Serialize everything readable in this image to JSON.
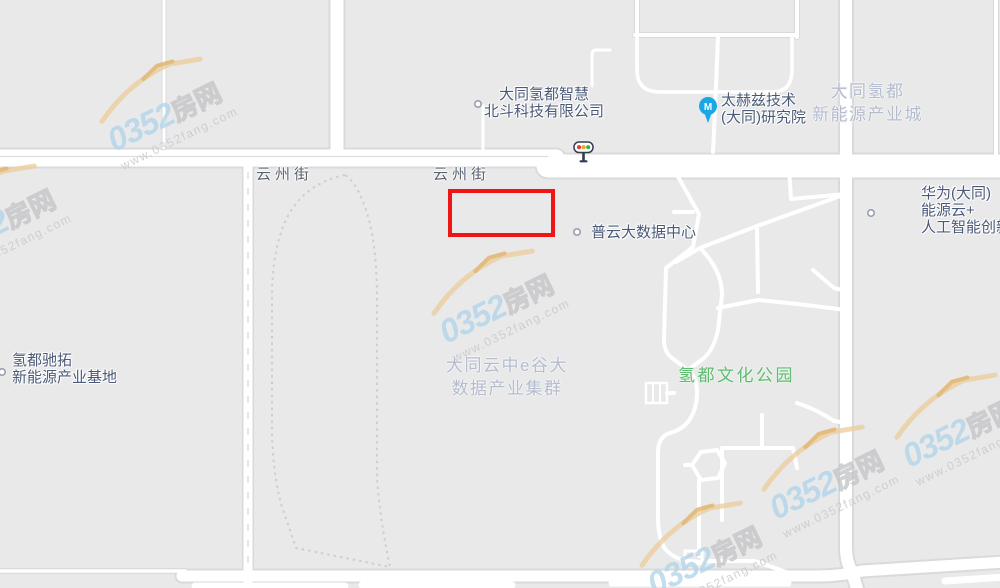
{
  "map": {
    "road_labels": [
      {
        "text": "云州街",
        "x": 256,
        "y": 163
      },
      {
        "text": "云州街",
        "x": 433,
        "y": 163
      }
    ],
    "poi_labels": [
      {
        "id": "beidou-tech",
        "type": "poi",
        "align": "center",
        "x": 484,
        "y": 86,
        "lines": [
          "大同氢都智慧",
          "北斗科技有限公司"
        ]
      },
      {
        "id": "terahertz-institute",
        "type": "poi",
        "x": 721,
        "y": 92,
        "lines": [
          "太赫兹技术",
          "(大同)研究院"
        ]
      },
      {
        "id": "qingdu-industry-city",
        "type": "area",
        "align": "center",
        "x": 812,
        "y": 80,
        "lines": [
          "大同氢都",
          "新能源产业城"
        ]
      },
      {
        "id": "huawei-energy-cloud",
        "type": "poi",
        "x": 921,
        "y": 185,
        "lines": [
          "华为(大同)",
          "能源云+",
          "人工智能创新"
        ]
      },
      {
        "id": "puyun-data-center",
        "type": "poi",
        "x": 591,
        "y": 224,
        "lines": [
          "普云大数据中心"
        ]
      },
      {
        "id": "chituo-base",
        "type": "poi",
        "x": 12,
        "y": 352,
        "lines": [
          "氢都驰拓",
          "新能源产业基地"
        ]
      },
      {
        "id": "egu-data-cluster",
        "type": "area",
        "align": "center",
        "x": 446,
        "y": 354,
        "lines": [
          "大同云中e谷大",
          "数据产业集群"
        ]
      },
      {
        "id": "qingdu-culture-park",
        "type": "park",
        "x": 678,
        "y": 366,
        "lines": [
          "氢都文化公园"
        ]
      }
    ],
    "markers": {
      "dots": [
        {
          "x": 478,
          "y": 104
        },
        {
          "x": 577,
          "y": 232
        },
        {
          "x": 871,
          "y": 213
        },
        {
          "x": 2,
          "y": 372
        }
      ],
      "pin": {
        "x": 708,
        "y": 106,
        "glyph": "M",
        "color": "#19a7e8"
      },
      "traffic_light": {
        "x": 574,
        "y": 142
      }
    },
    "highlight": {
      "x": 448,
      "y": 189,
      "w": 107,
      "h": 48,
      "color": "#ee1515"
    },
    "watermark": {
      "brand_number": "0352",
      "brand_suffix": "房网",
      "url": "www.0352fang.com",
      "instances": [
        {
          "x": 98,
          "y": 58
        },
        {
          "x": -68,
          "y": 165
        },
        {
          "x": 430,
          "y": 250
        },
        {
          "x": 760,
          "y": 426
        },
        {
          "x": 893,
          "y": 374
        },
        {
          "x": 638,
          "y": 502
        }
      ]
    },
    "colors": {
      "background": "#e9e9ea",
      "road_fill": "#ffffff",
      "road_casing": "#d9dadc",
      "poi_text": "#4a5977",
      "area_text": "#b5bccd",
      "park_text": "#5fba72",
      "road_text": "#596070",
      "highlight_red": "#ee1515",
      "pin_blue": "#19a7e8"
    }
  }
}
